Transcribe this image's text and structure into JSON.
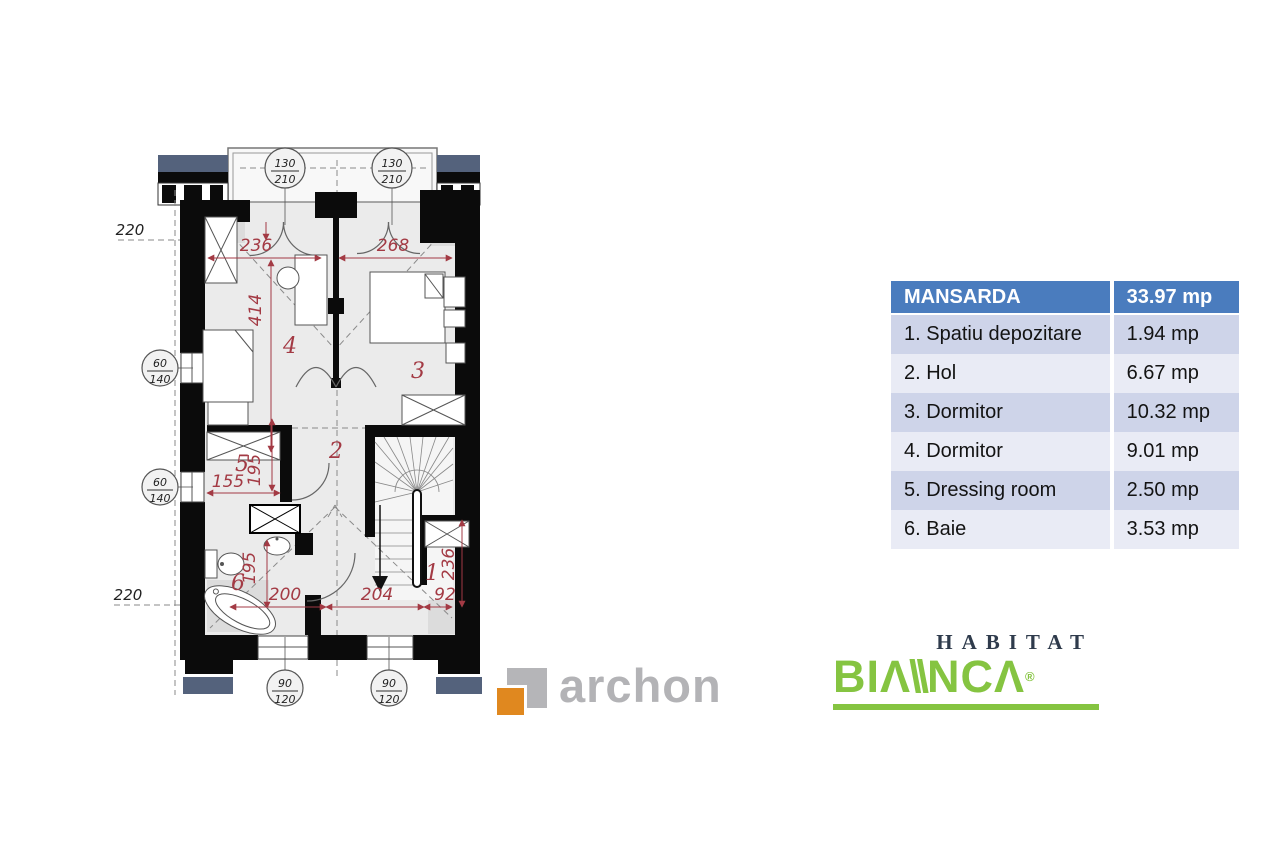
{
  "table": {
    "header": {
      "name": "MANSARDA",
      "area": "33.97 mp"
    },
    "rows": [
      {
        "name": "1. Spatiu depozitare",
        "area": "1.94 mp"
      },
      {
        "name": "2. Hol",
        "area": "6.67 mp"
      },
      {
        "name": "3. Dormitor",
        "area": "10.32 mp"
      },
      {
        "name": "4. Dormitor",
        "area": "9.01 mp"
      },
      {
        "name": "5. Dressing room",
        "area": "2.50 mp"
      },
      {
        "name": "6. Baie",
        "area": "3.53 mp"
      }
    ]
  },
  "plan": {
    "rooms": {
      "n1": "1",
      "n2": "2",
      "n3": "3",
      "n4": "4",
      "n5": "5",
      "n6": "6"
    },
    "dims": {
      "top_left": "236",
      "top_right": "268",
      "height_left": "414",
      "dressing_w": "155",
      "dressing_h": "195",
      "bath_h": "195",
      "bottom_left": "200",
      "bottom_mid": "204",
      "bottom_right": "92",
      "storage_h": "236",
      "eave_top": "220",
      "eave_bottom": "220"
    },
    "window_tags": {
      "t1a": "130",
      "t1b": "210",
      "t2a": "130",
      "t2b": "210",
      "l1a": "60",
      "l1b": "140",
      "l2a": "60",
      "l2b": "140",
      "b1a": "90",
      "b1b": "120",
      "b2a": "90",
      "b2b": "120"
    }
  },
  "logos": {
    "archon_text": "archon",
    "habitat": "HABITAT",
    "bianca": {
      "p1": "BI",
      "a1": "Λ",
      "slashes": "\\\\",
      "p2": "NC",
      "a2": "Λ",
      "reg": "®"
    }
  },
  "colors": {
    "table_header_bg": "#4a7cbe",
    "table_row_odd": "#ced4e9",
    "table_row_even": "#e9ebf5",
    "dim_red": "#a33a44",
    "roof_blue": "#54627c",
    "archon_orange": "#e0881f",
    "archon_gray": "#b3b3b6",
    "bianca_green": "#85c441",
    "habitat_navy": "#2f3b4c"
  }
}
